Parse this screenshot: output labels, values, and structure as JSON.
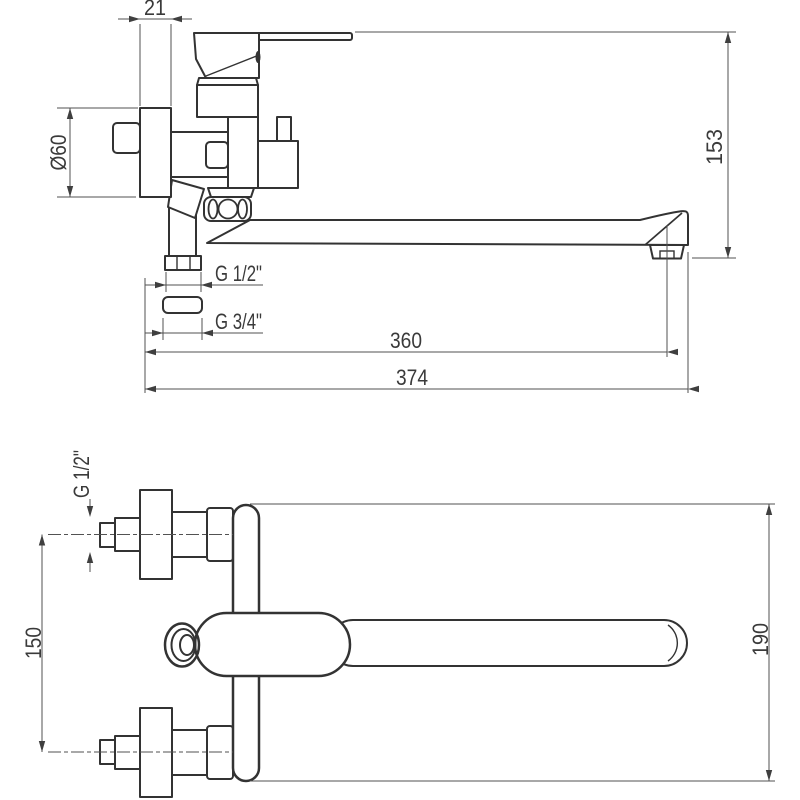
{
  "drawing": {
    "type": "faucet-dimension-drawing",
    "line_color": "#333333",
    "dim_line_color": "#525252",
    "text_color": "#3a3a3a",
    "background": "#ffffff",
    "side_view": {
      "dims": {
        "escutcheon_depth": "21",
        "escutcheon_diameter": "Ø60",
        "overall_height": "153",
        "shower_outlet_thread": "G 1/2\"",
        "spout_nut_thread": "G 3/4\"",
        "reach_to_aerator": "360",
        "overall_reach": "374"
      }
    },
    "plan_view": {
      "dims": {
        "inlet_thread": "G 1/2\"",
        "inlet_spacing": "150",
        "body_length": "190"
      }
    }
  }
}
